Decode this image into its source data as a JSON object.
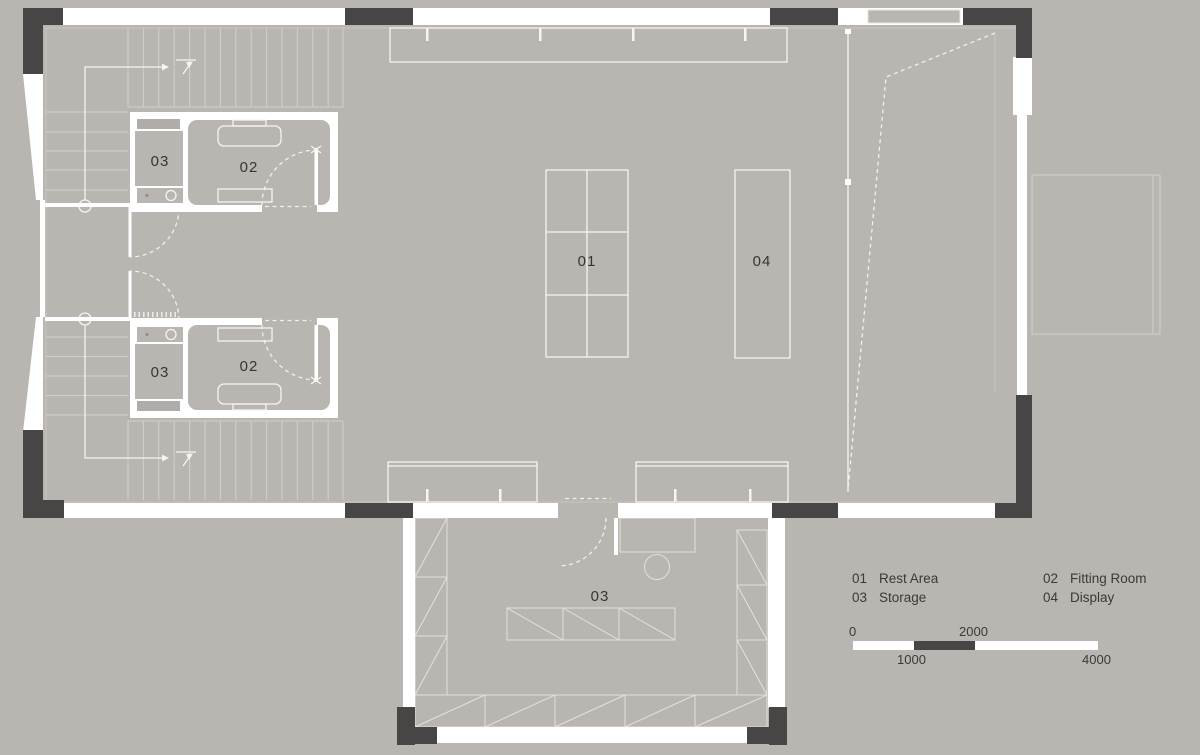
{
  "plan": {
    "labels": {
      "rest_area_num": "01",
      "display_num": "04",
      "fitting_a_num": "02",
      "storage_a_num": "03",
      "fitting_b_num": "02",
      "storage_b_num": "03",
      "storage_main_num": "03"
    }
  },
  "legend": {
    "items": [
      {
        "num": "01",
        "label": "Rest Area"
      },
      {
        "num": "02",
        "label": "Fitting Room"
      },
      {
        "num": "03",
        "label": "Storage"
      },
      {
        "num": "04",
        "label": "Display"
      }
    ]
  },
  "scale_bar": {
    "tick_0": "0",
    "tick_2000": "2000",
    "tick_1000": "1000",
    "tick_4000": "4000"
  },
  "colors": {
    "background": "#b9b5b1",
    "wall_dark": "#474645",
    "wall_white": "#ffffff",
    "drawing_line": "#f2f0ed",
    "text": "#3a3a3a"
  }
}
